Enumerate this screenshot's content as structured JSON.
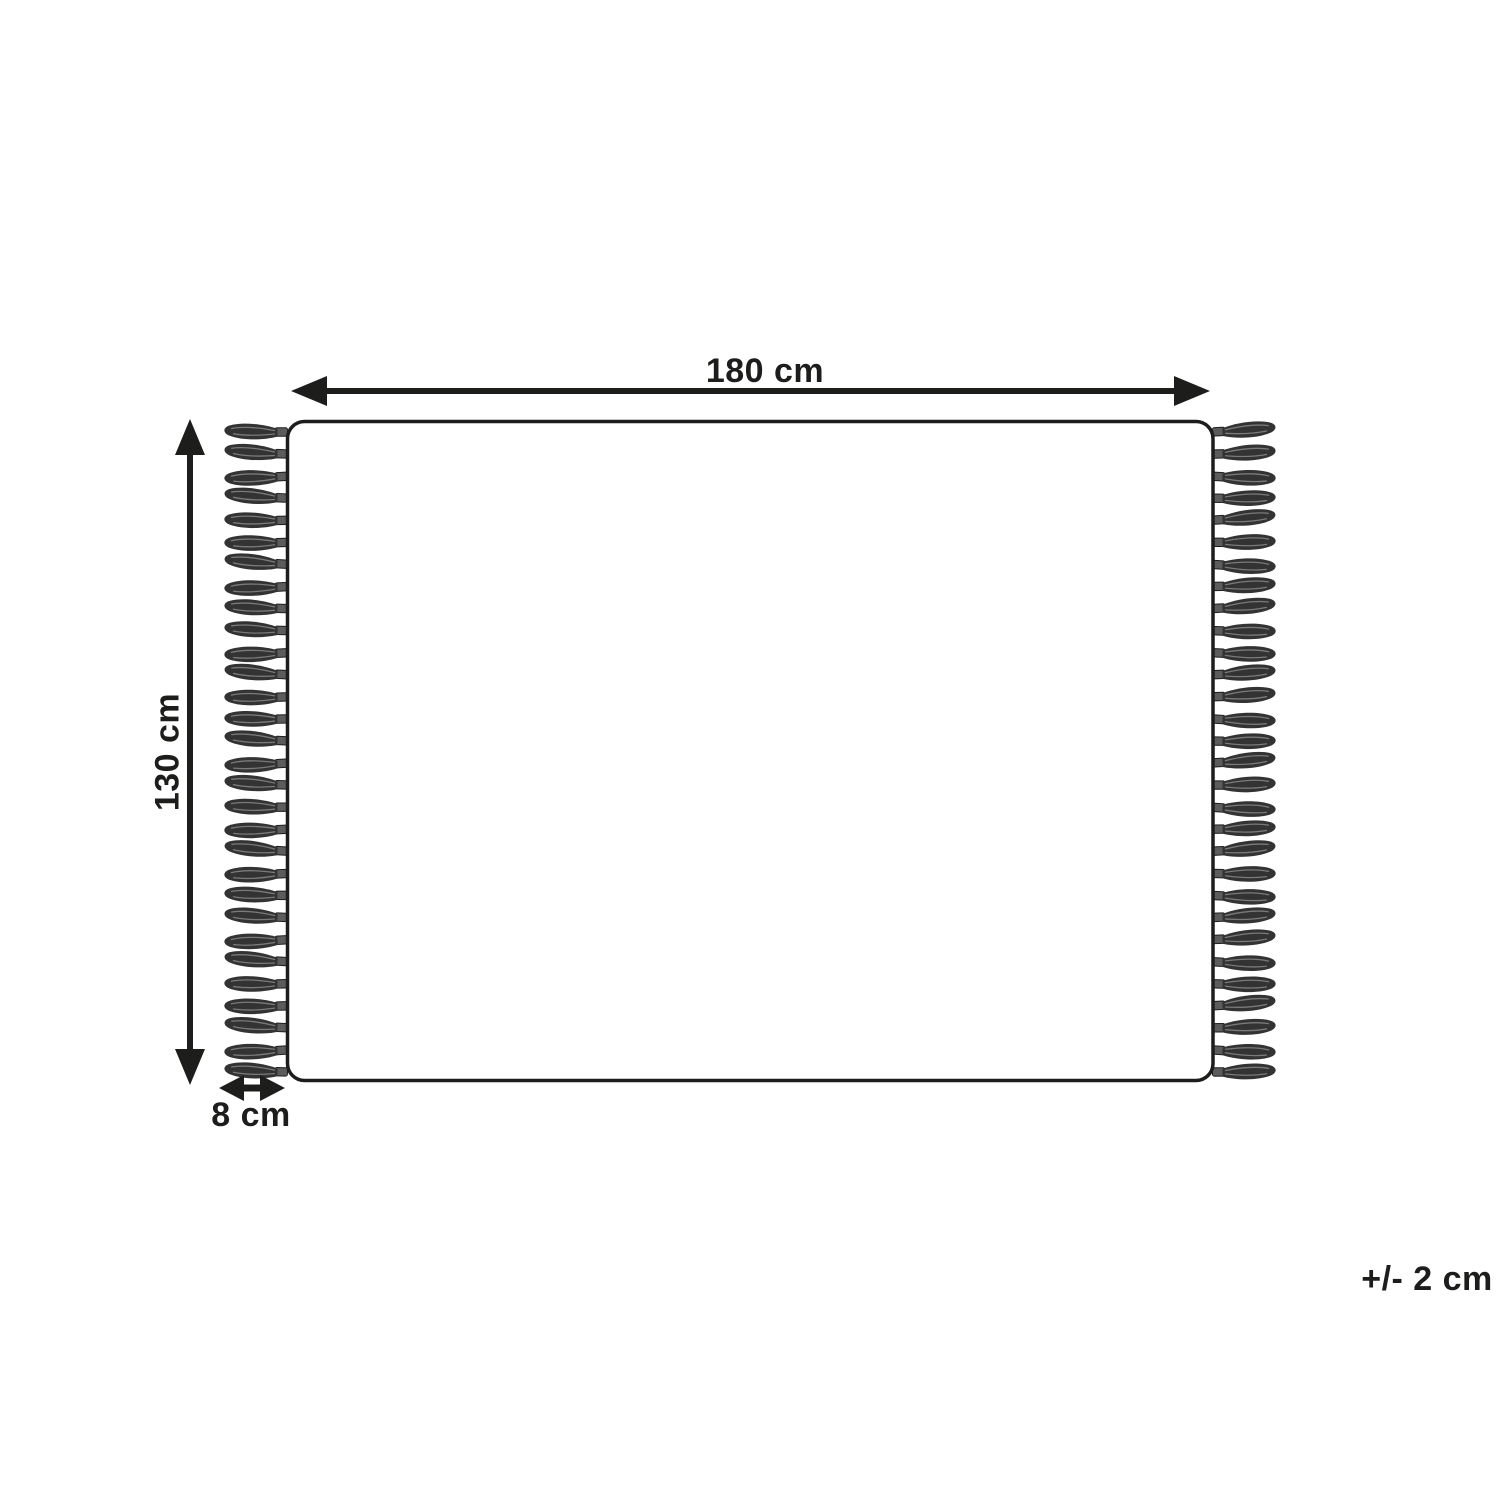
{
  "diagram": {
    "type": "product-dimension-diagram",
    "subject": "rug-with-tassels",
    "labels": {
      "width": "180 cm",
      "height": "130 cm",
      "fringe": "8 cm",
      "tolerance": "+/- 2 cm"
    },
    "tassels_per_side": 30,
    "colors": {
      "ink": "#1d1d1b",
      "background": "#ffffff",
      "tassel_body": "#333333",
      "tassel_knot": "#5c5c5c",
      "tassel_streak": "#7a7a7a"
    }
  }
}
